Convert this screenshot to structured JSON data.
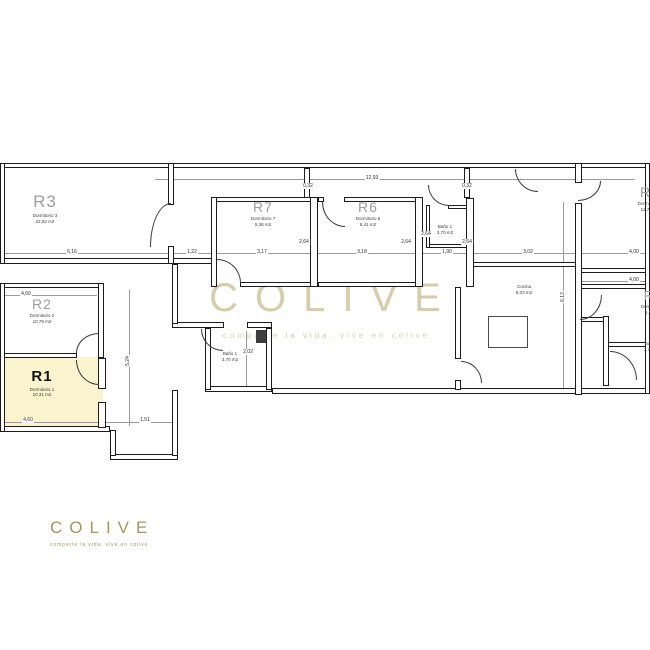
{
  "branding": {
    "logo_text": "COLIVE",
    "logo_tagline": "comparte la vida, vive en colive",
    "watermark_text": "COLIVE",
    "watermark_tagline": "comparte la vida, vive en colive",
    "gold_color": "#A8955A"
  },
  "floorplan": {
    "highlight_color": "#FBF3CD",
    "highlighted_room": "R1",
    "rooms": [
      {
        "id": "r3",
        "code": "R3",
        "name": "Dormitorio 3",
        "area": "22,82 m2"
      },
      {
        "id": "r2",
        "code": "R2",
        "name": "Dormitorio 2",
        "area": "10,79 m2"
      },
      {
        "id": "r1",
        "code": "R1",
        "name": "Dormitorio 1",
        "area": "10,31 m2",
        "bold": true
      },
      {
        "id": "r7",
        "code": "R7",
        "name": "Dormitorio 7",
        "area": "5,38 m2"
      },
      {
        "id": "r6",
        "code": "R6",
        "name": "Dormitorio 6",
        "area": "8,41 m2"
      },
      {
        "id": "r4",
        "code": "R4",
        "name": "Dormitorio 4",
        "area": "12,73 m2"
      },
      {
        "id": "r5",
        "code": "R5",
        "name": "Dormitorio 5",
        "area": "6,32 m2"
      },
      {
        "id": "bano1-top",
        "code": "",
        "name": "Baño 1",
        "area": "3,70 m2"
      },
      {
        "id": "bano1-mid",
        "code": "",
        "name": "Baño 1",
        "area": "3,70 m2"
      },
      {
        "id": "cocina",
        "code": "",
        "name": "Cocina",
        "area": "8,03 m2"
      },
      {
        "id": "bano2",
        "code": "",
        "name": "Baño 2",
        "area": "3,70 m2"
      }
    ],
    "dimensions": [
      "12,93",
      "0,32",
      "0,32",
      "6,16",
      "1,22",
      "3,17",
      "3,18",
      "1,90",
      "3,02",
      "4,00",
      "4,00",
      "2,64",
      "2,64",
      "2,64",
      "2,64",
      "4,60",
      "4,60",
      "1,51",
      "2,02",
      "5,24",
      "6,12"
    ]
  }
}
